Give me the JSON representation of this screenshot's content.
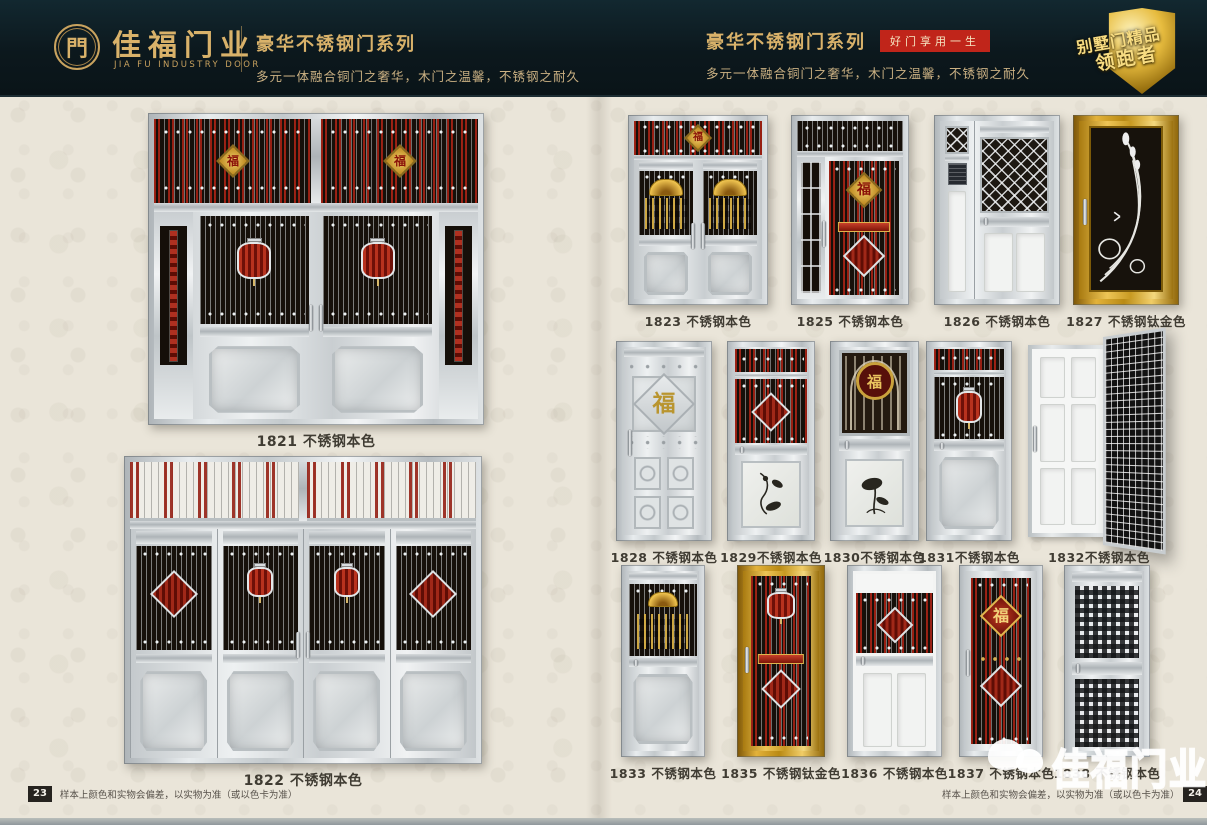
{
  "header": {
    "logo_glyph": "門",
    "brand": "佳福门业",
    "brand_en": "JIA FU INDUSTRY DOOR",
    "left_series_title": "豪华不锈钢门系列",
    "left_series_subtitle": "多元一体融合铜门之奢华，木门之温馨，不锈钢之耐久",
    "right_series_title": "豪华不锈钢门系列",
    "right_slogan_badge": "好门享用一生",
    "right_series_subtitle": "多元一体融合铜门之奢华，木门之温馨，不锈钢之耐久",
    "medal_line1": "别墅门精品",
    "medal_line2": "领跑者"
  },
  "left_page": {
    "doors": [
      {
        "id": "1821",
        "label": "1821 不锈钢本色",
        "finish": "不锈钢本色",
        "style": "four-leaf-lantern"
      },
      {
        "id": "1822",
        "label": "1822 不锈钢本色",
        "finish": "不锈钢本色",
        "style": "four-leaf"
      }
    ],
    "footer_page_number": "23",
    "footer_disclaimer": "样本上颜色和实物会偏差，以实物为准（或以色卡为准）"
  },
  "right_page": {
    "doors": [
      {
        "id": "1823",
        "label": "1823 不锈钢本色",
        "finish": "不锈钢本色",
        "style": "double-fan"
      },
      {
        "id": "1825",
        "label": "1825 不锈钢本色",
        "finish": "不锈钢本色",
        "style": "mother-son-fu"
      },
      {
        "id": "1826",
        "label": "1826 不锈钢本色",
        "finish": "不锈钢本色",
        "style": "mother-son-lattice"
      },
      {
        "id": "1827",
        "label": "1827 不锈钢钛金色",
        "finish": "不锈钢钛金色",
        "style": "gold-scroll"
      },
      {
        "id": "1828",
        "label": "1828 不锈钢本色",
        "finish": "不锈钢本色",
        "style": "embossed"
      },
      {
        "id": "1829",
        "label": "1829不锈钢本色",
        "finish": "不锈钢本色",
        "style": "grille-art"
      },
      {
        "id": "1830",
        "label": "1830不锈钢本色",
        "finish": "不锈钢本色",
        "style": "arch-grille"
      },
      {
        "id": "1831",
        "label": "1831不锈钢本色",
        "finish": "不锈钢本色",
        "style": "lantern-grille"
      },
      {
        "id": "1832",
        "label": "1832不锈钢本色",
        "finish": "不锈钢本色",
        "style": "open-mesh"
      },
      {
        "id": "1833",
        "label": "1833 不锈钢本色",
        "finish": "不锈钢本色",
        "style": "fan-emboss"
      },
      {
        "id": "1835",
        "label": "1835 不锈钢钛金色",
        "finish": "不锈钢钛金色",
        "style": "gold-grille"
      },
      {
        "id": "1836",
        "label": "1836 不锈钢本色",
        "finish": "不锈钢本色",
        "style": "white-grille"
      },
      {
        "id": "1837",
        "label": "1837 不锈钢本色",
        "finish": "不锈钢本色",
        "style": "full-grille"
      },
      {
        "id": "1838",
        "label": "1838 不锈钢本色",
        "finish": "不锈钢本色",
        "style": "perf-mesh"
      }
    ],
    "footer_page_number": "24",
    "footer_disclaimer": "样本上颜色和实物会偏差，以实物为准（或以色卡为准）",
    "watermark_text": "佳福门业"
  },
  "colors": {
    "header_bg": "#0c181d",
    "gold": "#d9b26a",
    "badge_red": "#c0251a",
    "page_bg": "#eae5d9",
    "label_text": "#403c33",
    "accent_red": "#9e2012",
    "titanium_gold": "#d9a62e",
    "grille_black": "#16100a"
  }
}
